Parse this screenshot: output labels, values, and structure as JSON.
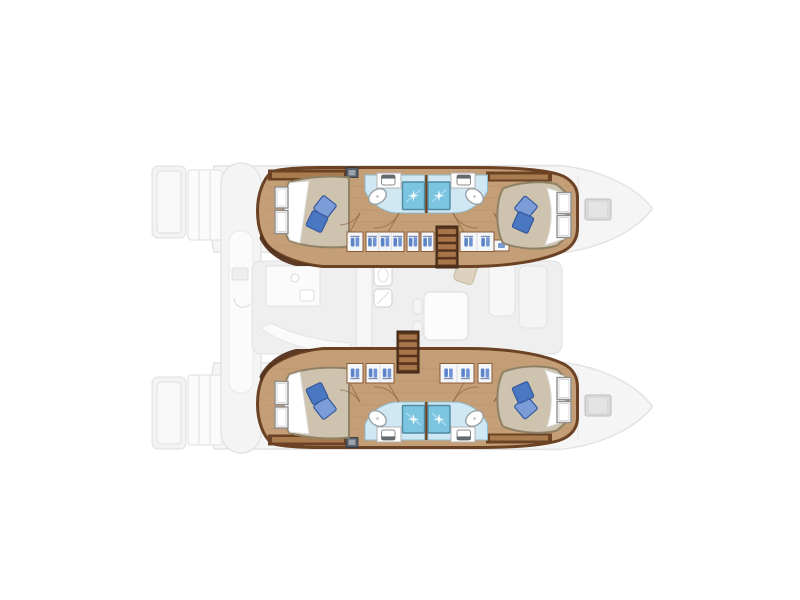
{
  "diagram": {
    "kind": "catamaran-floorplan-top-view",
    "orientation": {
      "stern": "left",
      "bow": "right"
    },
    "hulls": [
      {
        "id": "hull-top",
        "mirrored": false,
        "stairs_x": 436,
        "stairs_y": 226,
        "locker_segments": [
          [
            347,
            16
          ],
          [
            366,
            38
          ],
          [
            407,
            12
          ],
          [
            421,
            13
          ],
          [
            460,
            34
          ]
        ],
        "has_drawer_unit": true,
        "rooms": [
          "aft-cabin",
          "aft-bathroom",
          "forward-bathroom",
          "forward-cabin"
        ]
      },
      {
        "id": "hull-bottom",
        "mirrored": true,
        "stairs_x": 397,
        "stairs_y": 242,
        "locker_segments": [
          [
            347,
            16
          ],
          [
            366,
            28
          ],
          [
            440,
            34
          ],
          [
            478,
            14
          ]
        ],
        "has_drawer_unit": false,
        "rooms": [
          "aft-cabin",
          "aft-bathroom",
          "forward-bathroom",
          "forward-cabin"
        ]
      }
    ],
    "counts": {
      "cabins": 4,
      "bathrooms": 4,
      "showers": 4,
      "double_berths": 4
    }
  },
  "colors": {
    "wood": "#c49e76",
    "woodStreak": "#ad8257",
    "trim": "#6b4324",
    "trimDark": "#53321c",
    "stepTread": "#a9764a",
    "stepTreadEdge": "#7a4e28",
    "bed": "#cdc3ae",
    "bedEdge": "#8f8166",
    "sheet": "#ffffff",
    "sheetEdge": "#dcdcd8",
    "pillowLight": "#7b9cd6",
    "pillowDark": "#4a77c2",
    "pillowEdge": "#35589c",
    "bathFloor": "#cfe8f3",
    "bathEdge": "#8fbacd",
    "shower": "#7cc5e1",
    "showerEdge": "#4f89a2",
    "fixture": "#ffffff",
    "fixtureEdge": "#98a1a6",
    "toiletLid": "#656a6e",
    "closet": "#f4f6f8",
    "closetEdge": "#8a5a36",
    "closetIcon": "#5b84c8",
    "closetIcon2": "#6f93d2",
    "hangerBar": "#46629c",
    "windowEdge": "#8f8f8f",
    "ventDark": "#565d66",
    "ventLight": "#99a2ab",
    "ghostFill": "#f3f3f3",
    "ghostLine": "#dfdfdf",
    "ghostWhite": "#fbfbfb",
    "hatch": "#d9d9d9",
    "hatchEdge": "#c0c0c0",
    "ghostTan": "#d9cdb7",
    "ghostTanEdge": "#c0b192"
  }
}
